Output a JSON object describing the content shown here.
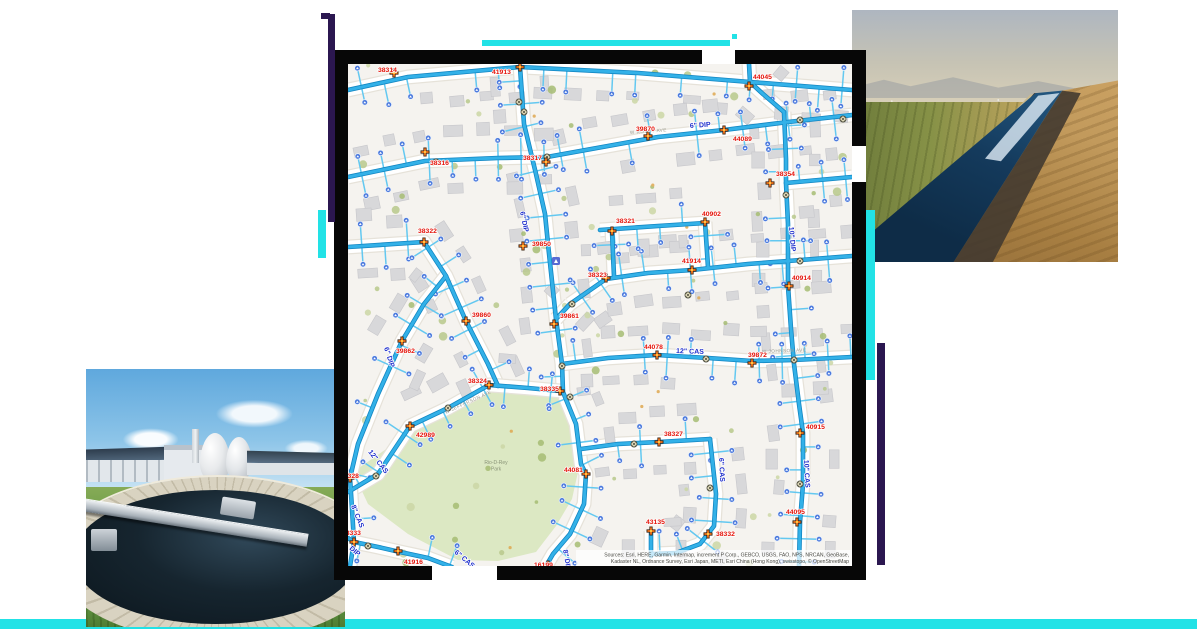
{
  "composition": {
    "accent_cyan": "#22e2e6",
    "accent_purple": "#2b1750",
    "frame_black": "#070707"
  },
  "photos": {
    "canal": {
      "alt": "irrigation canal running through farm fields"
    },
    "plant": {
      "alt": "water treatment plant with circular clarifier and egg digesters"
    }
  },
  "map": {
    "background": "#f5f3ef",
    "colors": {
      "main": "#33b1e8",
      "casing": "#1286c2",
      "stub": "#63c8f0",
      "road": "#ffffff",
      "road_casing": "#e6e2d9",
      "label_red": "#e41309",
      "label_blue": "#1e2ecc",
      "street": "#9b9b90",
      "meter": "#4b79dd",
      "hydrant": "#f4731c",
      "hydrant_dark": "#3a2413",
      "valve_fill": "#f7f0cd",
      "valve_stroke": "#4a4a3a",
      "building": "#d8d8da",
      "building_stroke": "#c7c7cb",
      "park_fill": "#dce8c3",
      "park_text": "#8a9478",
      "tree_greens": [
        "#b9c98c",
        "#a7bd74",
        "#ccd7a6"
      ],
      "tree_orange": "#dfa851",
      "attr_text": "#4a4a44"
    },
    "park": {
      "points": [
        [
          5,
          408
        ],
        [
          60,
          370
        ],
        [
          100,
          346
        ],
        [
          140,
          323
        ],
        [
          178,
          326
        ],
        [
          210,
          329
        ],
        [
          222,
          340
        ],
        [
          226,
          380
        ],
        [
          230,
          408
        ],
        [
          224,
          435
        ],
        [
          208,
          462
        ],
        [
          188,
          488
        ],
        [
          150,
          497
        ],
        [
          110,
          496
        ],
        [
          60,
          470
        ],
        [
          20,
          440
        ]
      ],
      "label": [
        "Rio-D-Rey",
        "Park"
      ]
    },
    "mains": [
      [
        [
          0,
          26
        ],
        [
          60,
          13
        ],
        [
          172,
          3
        ],
        [
          290,
          9
        ],
        [
          402,
          18
        ],
        [
          504,
          26
        ]
      ],
      [
        [
          172,
          3
        ],
        [
          176,
          60
        ],
        [
          188,
          110
        ],
        [
          197,
          150
        ],
        [
          200,
          180
        ],
        [
          208,
          255
        ],
        [
          214,
          300
        ],
        [
          215,
          328
        ],
        [
          228,
          360
        ],
        [
          233,
          400
        ],
        [
          238,
          410
        ],
        [
          236,
          440
        ],
        [
          222,
          470
        ],
        [
          205,
          490
        ],
        [
          198,
          502
        ]
      ],
      [
        [
          199,
          93
        ],
        [
          260,
          82
        ],
        [
          310,
          73
        ],
        [
          376,
          66
        ],
        [
          440,
          58
        ],
        [
          504,
          51
        ]
      ],
      [
        [
          0,
          113
        ],
        [
          77,
          97
        ],
        [
          150,
          94
        ],
        [
          199,
          93
        ]
      ],
      [
        [
          436,
          48
        ],
        [
          438,
          95
        ],
        [
          438,
          119
        ],
        [
          440,
          160
        ],
        [
          440,
          222
        ],
        [
          443,
          265
        ],
        [
          446,
          300
        ],
        [
          451,
          340
        ],
        [
          455,
          369
        ],
        [
          455,
          420
        ],
        [
          452,
          458
        ],
        [
          451,
          502
        ]
      ],
      [
        [
          438,
          119
        ],
        [
          504,
          113
        ]
      ],
      [
        [
          0,
          183
        ],
        [
          76,
          178
        ],
        [
          98,
          212
        ],
        [
          118,
          257
        ],
        [
          140,
          300
        ],
        [
          150,
          322
        ]
      ],
      [
        [
          0,
          428
        ],
        [
          30,
          410
        ],
        [
          62,
          362
        ],
        [
          100,
          344
        ],
        [
          141,
          321
        ],
        [
          180,
          324
        ],
        [
          212,
          327
        ]
      ],
      [
        [
          98,
          212
        ],
        [
          76,
          240
        ],
        [
          54,
          277
        ],
        [
          30,
          330
        ],
        [
          10,
          380
        ],
        [
          2,
          414
        ],
        [
          4,
          445
        ],
        [
          6,
          478
        ]
      ],
      [
        [
          0,
          474
        ],
        [
          6,
          478
        ],
        [
          30,
          483
        ],
        [
          52,
          488
        ],
        [
          80,
          494
        ],
        [
          104,
          503
        ]
      ],
      [
        [
          6,
          478
        ],
        [
          2,
          502
        ]
      ],
      [
        [
          214,
          300
        ],
        [
          260,
          294
        ],
        [
          309,
          291
        ],
        [
          360,
          294
        ],
        [
          404,
          297
        ],
        [
          446,
          296
        ],
        [
          504,
          293
        ]
      ],
      [
        [
          222,
          240
        ],
        [
          258,
          215
        ],
        [
          300,
          209
        ],
        [
          344,
          206
        ],
        [
          400,
          200
        ],
        [
          440,
          197
        ],
        [
          504,
          192
        ]
      ],
      [
        [
          252,
          166
        ],
        [
          310,
          162
        ],
        [
          357,
          159
        ]
      ],
      [
        [
          264,
          167
        ],
        [
          266,
          212
        ]
      ],
      [
        [
          357,
          158
        ],
        [
          360,
          203
        ]
      ],
      [
        [
          233,
          385
        ],
        [
          270,
          380
        ],
        [
          311,
          378
        ],
        [
          362,
          375
        ]
      ],
      [
        [
          362,
          375
        ],
        [
          368,
          430
        ],
        [
          366,
          462
        ],
        [
          352,
          480
        ],
        [
          328,
          489
        ],
        [
          305,
          490
        ]
      ],
      [
        [
          303,
          467
        ],
        [
          303,
          492
        ]
      ],
      [
        [
          402,
          18
        ],
        [
          415,
          30
        ],
        [
          436,
          48
        ]
      ],
      [
        [
          402,
          18
        ],
        [
          401,
          0
        ]
      ],
      [
        [
          208,
          255
        ],
        [
          222,
          240
        ]
      ]
    ],
    "valves": [
      [
        176,
        48
      ],
      [
        199,
        93
      ],
      [
        88,
        98
      ],
      [
        452,
        56
      ],
      [
        495,
        55
      ],
      [
        438,
        131
      ],
      [
        340,
        231
      ],
      [
        224,
        240
      ],
      [
        452,
        197
      ],
      [
        214,
        302
      ],
      [
        358,
        295
      ],
      [
        446,
        296
      ],
      [
        222,
        333
      ],
      [
        100,
        344
      ],
      [
        28,
        412
      ],
      [
        20,
        482
      ],
      [
        452,
        420
      ],
      [
        286,
        380
      ],
      [
        362,
        424
      ],
      [
        171,
        38
      ]
    ],
    "assets": [
      {
        "id": "38314",
        "lx": 30,
        "ly": 2,
        "mx": 46,
        "my": 9
      },
      {
        "id": "41913",
        "lx": 144,
        "ly": 4,
        "mx": 172,
        "my": 3
      },
      {
        "id": "44045",
        "lx": 405,
        "ly": 9,
        "mx": 401,
        "my": 22
      },
      {
        "id": "39870",
        "lx": 288,
        "ly": 61,
        "mx": 300,
        "my": 72
      },
      {
        "id": "44089",
        "lx": 385,
        "ly": 71,
        "mx": 376,
        "my": 66
      },
      {
        "id": "38317",
        "lx": 175,
        "ly": 90,
        "mx": 198,
        "my": 98
      },
      {
        "id": "38316",
        "lx": 82,
        "ly": 95,
        "mx": 77,
        "my": 88
      },
      {
        "id": "38354",
        "lx": 428,
        "ly": 106,
        "mx": 422,
        "my": 119
      },
      {
        "id": "38322",
        "lx": 70,
        "ly": 163,
        "mx": 76,
        "my": 178
      },
      {
        "id": "39850",
        "lx": 184,
        "ly": 176,
        "mx": 175,
        "my": 182
      },
      {
        "id": "38321",
        "lx": 268,
        "ly": 153,
        "mx": 264,
        "my": 167
      },
      {
        "id": "40902",
        "lx": 354,
        "ly": 146,
        "mx": 357,
        "my": 158
      },
      {
        "id": "41914",
        "lx": 334,
        "ly": 193,
        "mx": 344,
        "my": 206
      },
      {
        "id": "38323",
        "lx": 240,
        "ly": 207,
        "mx": 258,
        "my": 214
      },
      {
        "id": "40914",
        "lx": 444,
        "ly": 210,
        "mx": 441,
        "my": 222
      },
      {
        "id": "39861",
        "lx": 212,
        "ly": 248,
        "mx": 206,
        "my": 260
      },
      {
        "id": "39860",
        "lx": 124,
        "ly": 247,
        "mx": 118,
        "my": 257
      },
      {
        "id": "39862",
        "lx": 48,
        "ly": 283,
        "mx": 54,
        "my": 277
      },
      {
        "id": "44078",
        "lx": 296,
        "ly": 279,
        "mx": 309,
        "my": 291
      },
      {
        "id": "39872",
        "lx": 400,
        "ly": 287,
        "mx": 404,
        "my": 299
      },
      {
        "id": "38324",
        "lx": 120,
        "ly": 313,
        "mx": 141,
        "my": 321
      },
      {
        "id": "38335",
        "lx": 192,
        "ly": 321,
        "mx": 212,
        "my": 327
      },
      {
        "id": "42989",
        "lx": 68,
        "ly": 367,
        "mx": 62,
        "my": 362
      },
      {
        "id": "38327",
        "lx": 316,
        "ly": 366,
        "mx": 311,
        "my": 378
      },
      {
        "id": "40915",
        "lx": 458,
        "ly": 359,
        "mx": 452,
        "my": 369
      },
      {
        "id": "44081",
        "lx": 216,
        "ly": 402,
        "mx": 238,
        "my": 410
      },
      {
        "id": "38328",
        "lx": -8,
        "ly": 408,
        "mx": 2,
        "my": 414
      },
      {
        "id": "43135",
        "lx": 298,
        "ly": 454,
        "mx": 303,
        "my": 467
      },
      {
        "id": "38332",
        "lx": 368,
        "ly": 466,
        "mx": 360,
        "my": 470
      },
      {
        "id": "44095",
        "lx": 438,
        "ly": 444,
        "mx": 449,
        "my": 458
      },
      {
        "id": "38333",
        "lx": -6,
        "ly": 465,
        "mx": 6,
        "my": 478
      },
      {
        "id": "41916",
        "lx": 56,
        "ly": 494,
        "mx": 50,
        "my": 487
      },
      {
        "id": "16199",
        "lx": 186,
        "ly": 497,
        "mx": 200,
        "my": 501
      }
    ],
    "pipe_labels": [
      {
        "t": "6\" DIP",
        "x": 342,
        "y": 64,
        "r": -4
      },
      {
        "t": "6\" DIP",
        "x": 172,
        "y": 148,
        "r": 78
      },
      {
        "t": "10\" DIP",
        "x": 441,
        "y": 163,
        "r": 85
      },
      {
        "t": "6\" DIP",
        "x": 36,
        "y": 284,
        "r": 72
      },
      {
        "t": "12\" CAS",
        "x": 328,
        "y": 289,
        "r": 2
      },
      {
        "t": "12\" CAS",
        "x": 20,
        "y": 388,
        "r": 52
      },
      {
        "t": "8\" CAS",
        "x": 3,
        "y": 442,
        "r": 68
      },
      {
        "t": "6\" CAS",
        "x": 371,
        "y": 394,
        "r": 87
      },
      {
        "t": "10\" CAS",
        "x": 456,
        "y": 396,
        "r": 87
      },
      {
        "t": "6\" CAS",
        "x": 106,
        "y": 489,
        "r": 40
      },
      {
        "t": "DIP",
        "x": 1,
        "y": 485,
        "r": 40
      },
      {
        "t": "8\" DIP",
        "x": 215,
        "y": 486,
        "r": 80
      }
    ],
    "street_labels": [
      {
        "t": "W JEFFERSON AVE",
        "x": 98,
        "y": 350,
        "r": -25
      },
      {
        "t": "W JOHNSON AVE",
        "x": 414,
        "y": 289,
        "r": -2
      },
      {
        "t": "W ROVEY AVE",
        "x": 282,
        "y": 70,
        "r": -4
      }
    ],
    "attribution": [
      "Sources: Esri, HERE, Garmin, Intermap, increment P Corp., GEBCO, USGS, FAO, NPS, NRCAN, GeoBase,",
      "Kadaster NL, Ordnance Survey, Esri Japan, METI, Esri China (Hong Kong), swisstopo, © OpenStreetMap"
    ]
  }
}
